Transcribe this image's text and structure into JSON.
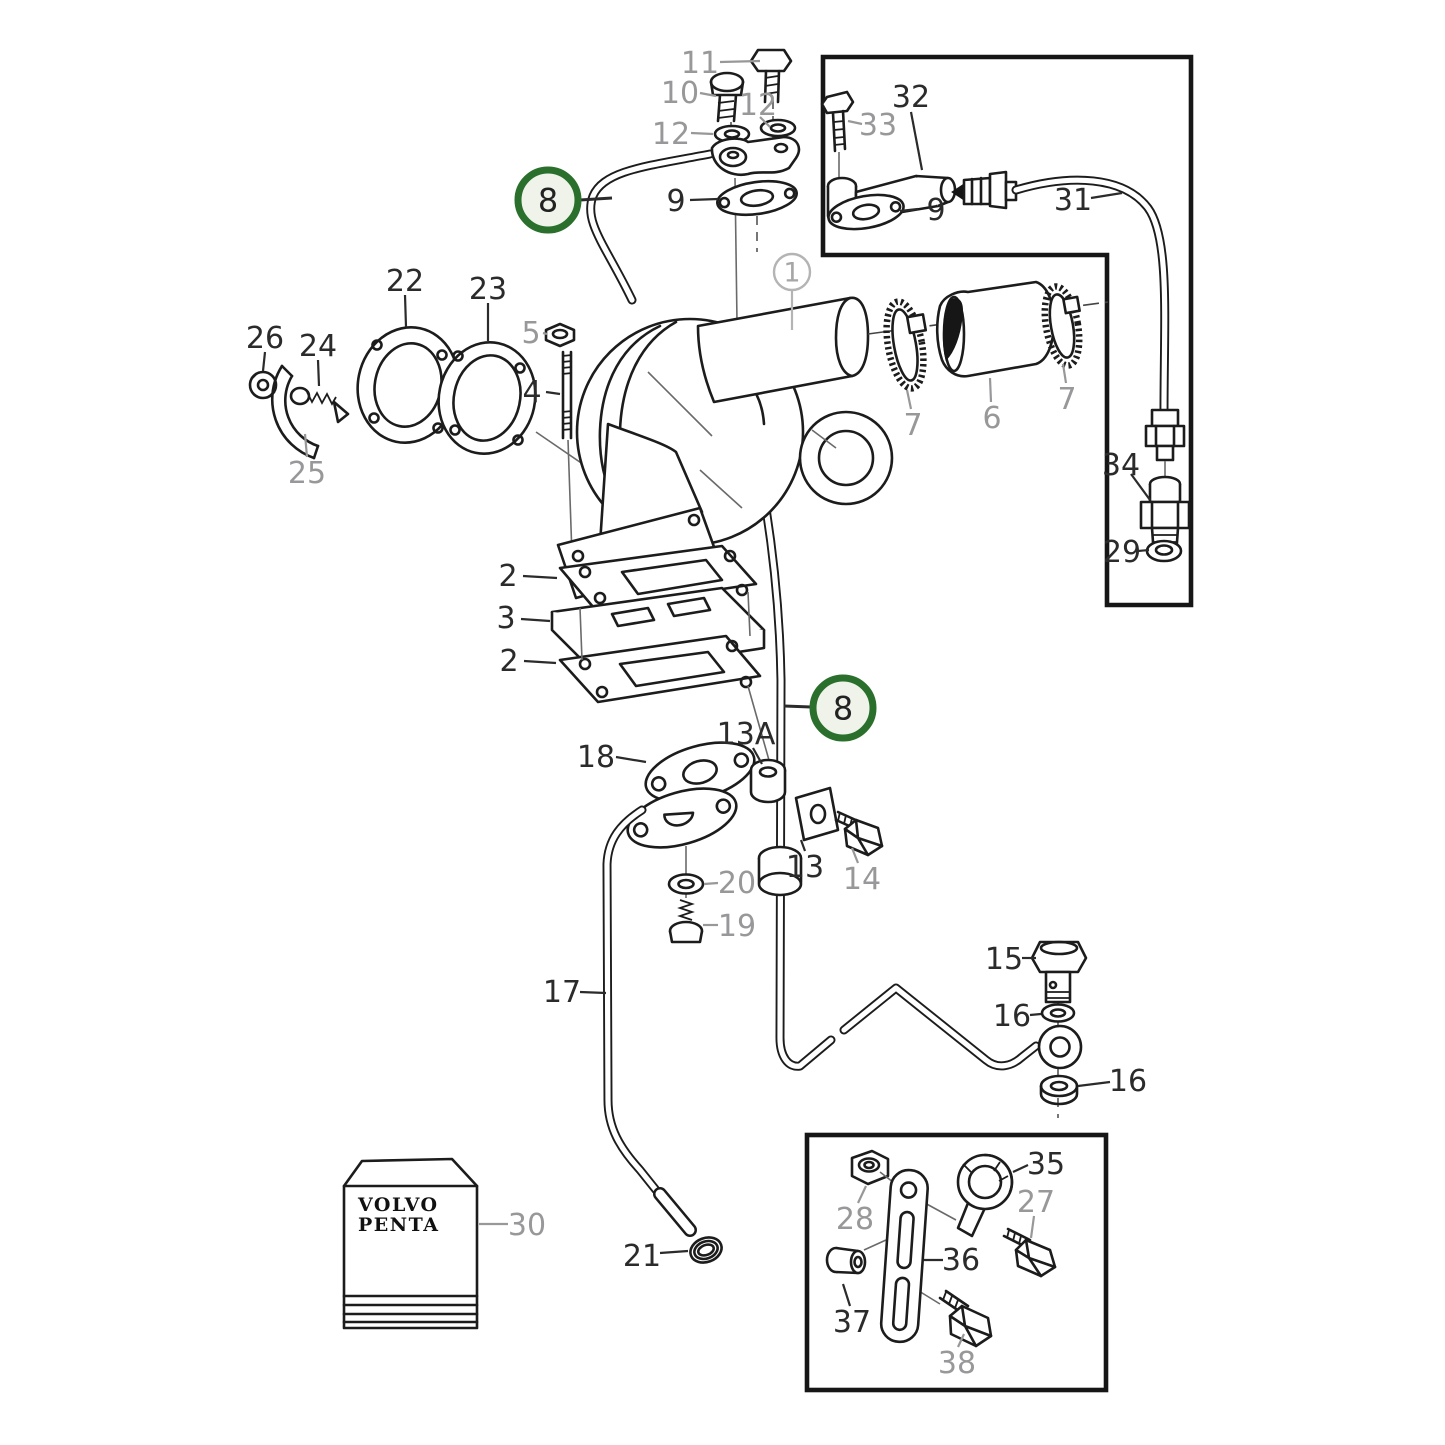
{
  "diagram": {
    "brand_box": {
      "line1": "VOLVO",
      "line2": "PENTA"
    },
    "highlighted_part_number": "8"
  },
  "colors": {
    "line": "#1c1c1c",
    "black_label": "#2b2b2b",
    "gray_label": "#98989a",
    "leader": "#2b2b2b",
    "green_ring": "#2a6f2c",
    "green_fill": "#eff3ea",
    "gray_circle": "#b4b4b4"
  },
  "part_labels": [
    {
      "text": "11",
      "x": 700,
      "y": 62,
      "style": "gray",
      "leader": [
        720,
        62,
        760,
        61
      ]
    },
    {
      "text": "10",
      "x": 680,
      "y": 92,
      "style": "gray",
      "leader": [
        700,
        93,
        716,
        96
      ]
    },
    {
      "text": "12",
      "x": 758,
      "y": 104,
      "style": "gray",
      "leader": [
        760,
        117,
        770,
        127
      ]
    },
    {
      "text": "12",
      "x": 671,
      "y": 133,
      "style": "gray",
      "leader": [
        691,
        133,
        713,
        134
      ]
    },
    {
      "text": "9",
      "x": 676,
      "y": 200,
      "style": "black",
      "leader": [
        690,
        200,
        718,
        199
      ]
    },
    {
      "text": "32",
      "x": 911,
      "y": 96,
      "style": "black",
      "leader": [
        911,
        112,
        922,
        170
      ]
    },
    {
      "text": "33",
      "x": 878,
      "y": 124,
      "style": "gray",
      "leader": [
        862,
        124,
        848,
        121
      ]
    },
    {
      "text": "9",
      "x": 936,
      "y": 209,
      "style": "black",
      "leader": [
        918,
        209,
        900,
        211
      ]
    },
    {
      "text": "31",
      "x": 1073,
      "y": 199,
      "style": "black",
      "leader": [
        1091,
        198,
        1122,
        193
      ]
    },
    {
      "text": "34",
      "x": 1121,
      "y": 464,
      "style": "black",
      "leader": [
        1131,
        474,
        1150,
        500
      ]
    },
    {
      "text": "29",
      "x": 1122,
      "y": 551,
      "style": "black",
      "leader": [
        1138,
        551,
        1149,
        550
      ]
    },
    {
      "text": "26",
      "x": 265,
      "y": 337,
      "style": "black",
      "leader": [
        265,
        352,
        263,
        371
      ]
    },
    {
      "text": "24",
      "x": 318,
      "y": 345,
      "style": "black",
      "leader": [
        318,
        360,
        319,
        386
      ]
    },
    {
      "text": "22",
      "x": 405,
      "y": 280,
      "style": "black",
      "leader": [
        405,
        295,
        406,
        327
      ]
    },
    {
      "text": "23",
      "x": 488,
      "y": 288,
      "style": "black",
      "leader": [
        488,
        303,
        488,
        341
      ]
    },
    {
      "text": "5",
      "x": 531,
      "y": 332,
      "style": "gray",
      "leader": [
        543,
        333,
        547,
        334
      ]
    },
    {
      "text": "4",
      "x": 532,
      "y": 391,
      "style": "black",
      "leader": [
        546,
        392,
        560,
        394
      ]
    },
    {
      "text": "25",
      "x": 307,
      "y": 472,
      "style": "gray",
      "leader": [
        307,
        457,
        305,
        434
      ]
    },
    {
      "text": "7",
      "x": 913,
      "y": 424,
      "style": "gray",
      "leader": [
        911,
        409,
        907,
        390
      ]
    },
    {
      "text": "6",
      "x": 992,
      "y": 417,
      "style": "gray",
      "leader": [
        991,
        402,
        990,
        378
      ]
    },
    {
      "text": "7",
      "x": 1067,
      "y": 398,
      "style": "gray",
      "leader": [
        1066,
        383,
        1063,
        364
      ]
    },
    {
      "text": "2",
      "x": 508,
      "y": 575,
      "style": "black",
      "leader": [
        523,
        576,
        557,
        578
      ]
    },
    {
      "text": "3",
      "x": 506,
      "y": 617,
      "style": "black",
      "leader": [
        521,
        619,
        550,
        621
      ]
    },
    {
      "text": "2",
      "x": 509,
      "y": 660,
      "style": "black",
      "leader": [
        524,
        661,
        556,
        663
      ]
    },
    {
      "text": "18",
      "x": 596,
      "y": 756,
      "style": "black",
      "leader": [
        616,
        757,
        646,
        762
      ]
    },
    {
      "text": "13A",
      "x": 746,
      "y": 733,
      "style": "black",
      "leader": [
        753,
        748,
        762,
        764
      ]
    },
    {
      "text": "13",
      "x": 805,
      "y": 866,
      "style": "black",
      "leader": [
        805,
        851,
        801,
        840
      ]
    },
    {
      "text": "14",
      "x": 862,
      "y": 878,
      "style": "gray",
      "leader": [
        858,
        863,
        852,
        848
      ]
    },
    {
      "text": "20",
      "x": 737,
      "y": 882,
      "style": "gray",
      "leader": [
        718,
        883,
        704,
        884
      ]
    },
    {
      "text": "19",
      "x": 737,
      "y": 925,
      "style": "gray",
      "leader": [
        718,
        925,
        703,
        925
      ]
    },
    {
      "text": "17",
      "x": 562,
      "y": 991,
      "style": "black",
      "leader": [
        580,
        992,
        606,
        993
      ]
    },
    {
      "text": "15",
      "x": 1004,
      "y": 958,
      "style": "black",
      "leader": [
        1022,
        958,
        1036,
        958
      ]
    },
    {
      "text": "16",
      "x": 1012,
      "y": 1015,
      "style": "black",
      "leader": [
        1030,
        1015,
        1041,
        1014
      ]
    },
    {
      "text": "16",
      "x": 1128,
      "y": 1080,
      "style": "black",
      "leader": [
        1110,
        1082,
        1078,
        1086
      ]
    },
    {
      "text": "21",
      "x": 642,
      "y": 1255,
      "style": "black",
      "leader": [
        660,
        1253,
        688,
        1251
      ]
    },
    {
      "text": "30",
      "x": 527,
      "y": 1224,
      "style": "gray",
      "leader": [
        508,
        1224,
        479,
        1224
      ]
    },
    {
      "text": "28",
      "x": 855,
      "y": 1218,
      "style": "gray",
      "leader": [
        858,
        1203,
        866,
        1186
      ]
    },
    {
      "text": "35",
      "x": 1046,
      "y": 1163,
      "style": "black",
      "leader": [
        1028,
        1165,
        1013,
        1172
      ]
    },
    {
      "text": "27",
      "x": 1036,
      "y": 1201,
      "style": "gray",
      "leader": [
        1034,
        1216,
        1031,
        1238
      ]
    },
    {
      "text": "36",
      "x": 961,
      "y": 1259,
      "style": "black",
      "leader": [
        943,
        1260,
        924,
        1260
      ]
    },
    {
      "text": "37",
      "x": 852,
      "y": 1321,
      "style": "black",
      "leader": [
        850,
        1306,
        843,
        1284
      ]
    },
    {
      "text": "38",
      "x": 957,
      "y": 1362,
      "style": "gray",
      "leader": [
        958,
        1347,
        964,
        1334
      ]
    },
    {
      "text": "1",
      "x": 792,
      "y": 272,
      "style": "gray-circle",
      "leader": [
        792,
        291,
        792,
        330
      ]
    },
    {
      "text": "8",
      "x": 548,
      "y": 200,
      "style": "green-circle",
      "leader": [
        580,
        200,
        612,
        198
      ]
    },
    {
      "text": "8",
      "x": 843,
      "y": 708,
      "style": "green-circle",
      "leader": [
        811,
        707,
        784,
        706
      ]
    }
  ]
}
